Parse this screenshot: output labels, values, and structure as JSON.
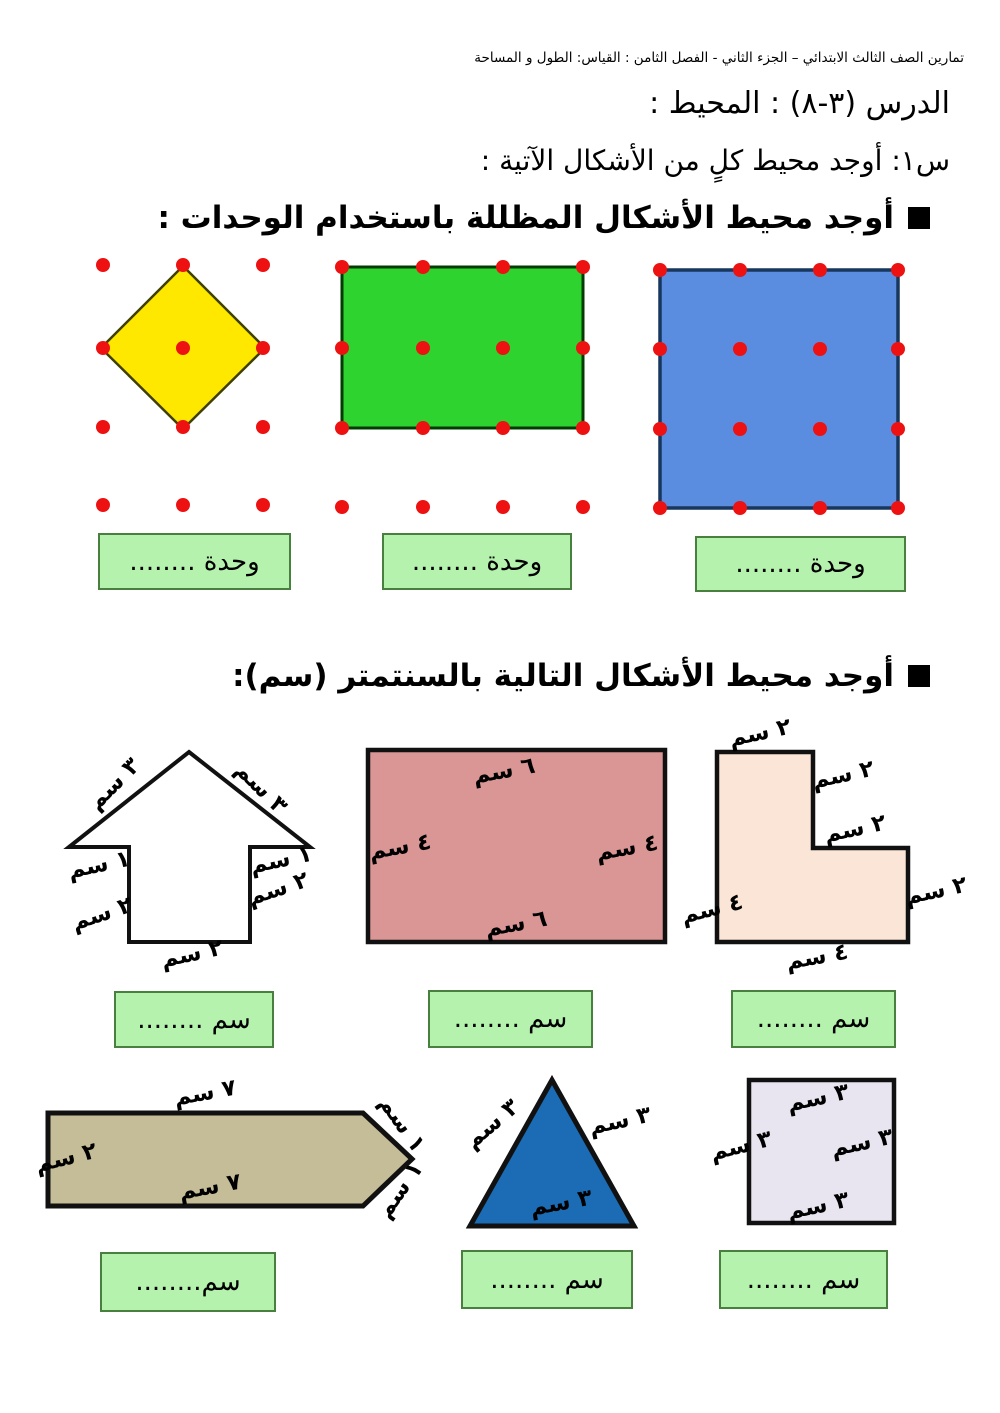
{
  "header": {
    "course_line": "تمارين الصف الثالث الابتدائي – الجزء الثاني - الفصل الثامن : القياس: الطول و المساحة"
  },
  "lesson": {
    "title": "الدرس (٣-٨) : المحيط :",
    "question": "س١: أوجد محيط كلٍ من الأشكال الآتية :"
  },
  "icons": {
    "section_bullet": "black-square"
  },
  "sections": {
    "units": {
      "heading": "أوجد محيط الأشكال المظللة باستخدام الوحدات :",
      "answers": [
        "........ وحدة",
        "........ وحدة",
        "........ وحدة"
      ]
    },
    "cm": {
      "heading": "أوجد محيط الأشكال التالية بالسنتمتر (سم):",
      "answers_row1": [
        "........ سم",
        "........ سم",
        "........ سم"
      ],
      "answers_row2": [
        "........سم",
        "........ سم",
        "........ سم"
      ],
      "labels": {
        "arrow": {
          "left_slant": "٣ سم",
          "right_slant": "٣ سم",
          "left_wing": "١ سم",
          "right_wing": "١ سم",
          "left_side": "٢ سم",
          "right_side": "٢ سم",
          "bottom": "٢ سم"
        },
        "rect": {
          "top": "٦ سم",
          "left": "٤ سم",
          "right": "٤ سم",
          "bottom": "٦ سم"
        },
        "lshape": {
          "top": "٢ سم",
          "upper_right": "٢ سم",
          "step": "٢ سم",
          "right": "٢ سم",
          "left": "٤ سم",
          "bottom": "٤ سم"
        },
        "pencil": {
          "top": "٧ سم",
          "left": "٢ سم",
          "bottom": "٧ سم",
          "tip_top": "١ سم",
          "tip_bottom": "١ سم"
        },
        "triangle": {
          "left": "٣ سم",
          "right": "٣ سم",
          "bottom": "٣ سم"
        },
        "square": {
          "top": "٣ سم",
          "right": "٣ سم",
          "left": "٣ سم",
          "bottom": "٣ سم"
        }
      }
    }
  },
  "colors": {
    "dot_red": "#ee1111",
    "diamond_yellow": "#ffe800",
    "grid_rect_green": "#2fd32f",
    "grid_square_blue": "#5a8ce0",
    "arrow_white": "#ffffff",
    "rect_pink": "#d99694",
    "lshape_peach": "#fbe5d6",
    "pencil_tan": "#c4bd97",
    "triangle_blue": "#1b6cb5",
    "square_lavender": "#e8e4f0",
    "answer_box_green": "#b4f2ae"
  }
}
